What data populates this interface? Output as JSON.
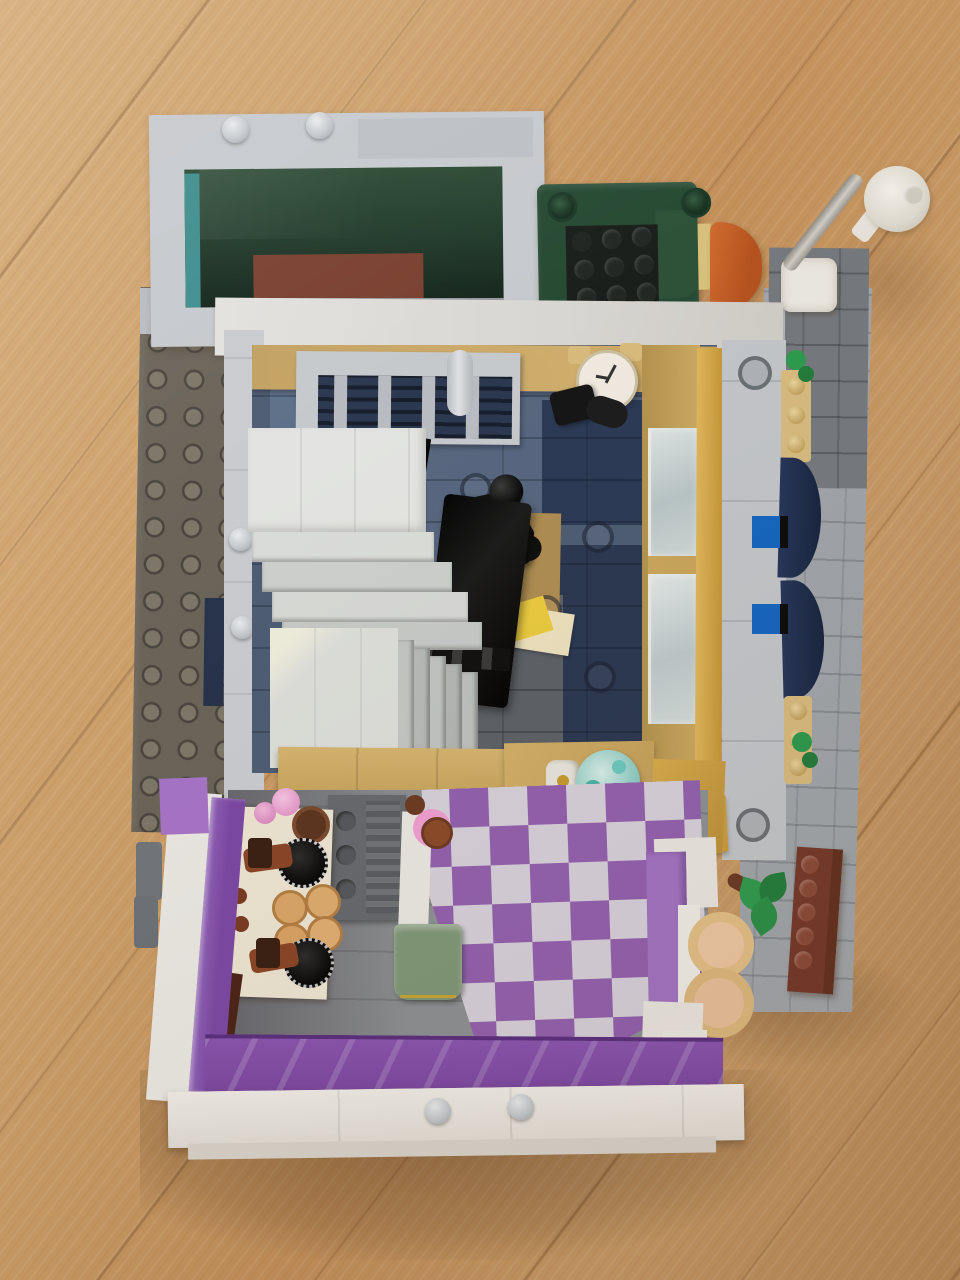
{
  "scene": {
    "type": "photograph",
    "description": "Top-down photo of an open-back LEGO modular building standing on a light oak wood floor with diagonal plank grain",
    "background": {
      "name": "wood-floor",
      "plank_direction": "diagonal",
      "colors": {
        "light": "#d4ab77",
        "mid": "#c3905a",
        "dark": "#b98a58",
        "plank_line": "#6e4623"
      }
    },
    "building": {
      "upper_terrace": {
        "frame_color": "#c6c9cd",
        "skylight_glass": "#223c2c",
        "teal_edge": "#3f8d8d",
        "interior_wood": "#7a4030",
        "objects": [
          "gray-frame-studs",
          "polished-gray-tile"
        ]
      },
      "roof_lounge": {
        "armchair": {
          "frame": "#274a33",
          "seat": "#1b1f1b",
          "studs": 9
        },
        "orange_seat": "#bf5c26",
        "street_lamp": {
          "base": "#eae7df",
          "pole": "#c0bcb4",
          "head": "#e8e4db"
        }
      },
      "office_floor": {
        "walls_tan": "#c3a263",
        "gold_window_wall": "#d2a850",
        "floor_tiles": [
          "#2c3a56",
          "#5a6a82",
          "#5e7089",
          "#5c6166",
          "#4e5d74"
        ],
        "objects": [
          "wall-clock",
          "black-camera",
          "tan-wrench",
          "radiator-grille",
          "candlestick-telephone",
          "yellow-papers",
          "black-piano-desk",
          "white-staircase",
          "crystal-ball",
          "tan-ledge"
        ]
      },
      "donut_shop": {
        "outer_wall": "#eae8e3",
        "lavender_trim": "#a273c2",
        "trans_purple_glass": "#7b48a4",
        "checker_floor": {
          "purple": "#9260ae",
          "white": "#d6d0da"
        },
        "objects": [
          "sage-cabinet",
          "oven-radiator",
          "pastry-shelf",
          "coffee-grinders",
          "nougat-buns",
          "pink-cupcakes",
          "donut-on-plate",
          "arch-windows",
          "white-pillar"
        ]
      },
      "exterior": {
        "baseplate": {
          "color": "#6a6459",
          "studs": true
        },
        "sidewalk": "#a0a5aa",
        "navy_awnings": "#1e2c4c",
        "tan_plates": "#d6ba7e",
        "blue_bricks": "#1565c0",
        "green_plants": "#2f9b4e",
        "brown_brick": "#74392a",
        "navy_tile": "#27334c"
      }
    }
  },
  "palette": {
    "lego_light_gray": "#c5c8cc",
    "lego_white": "#eae8e3",
    "lego_tan": "#c9a75f",
    "lego_gold": "#d3a94b",
    "lego_dark_green": "#274a33",
    "lego_orange": "#bf5c26",
    "lego_navy": "#1e2c4c",
    "lego_purple_trans": "#7b48a4",
    "lego_lavender": "#a273c2",
    "lego_sage": "#7e9778",
    "lego_black": "#141414",
    "wood": "#c79a66"
  }
}
